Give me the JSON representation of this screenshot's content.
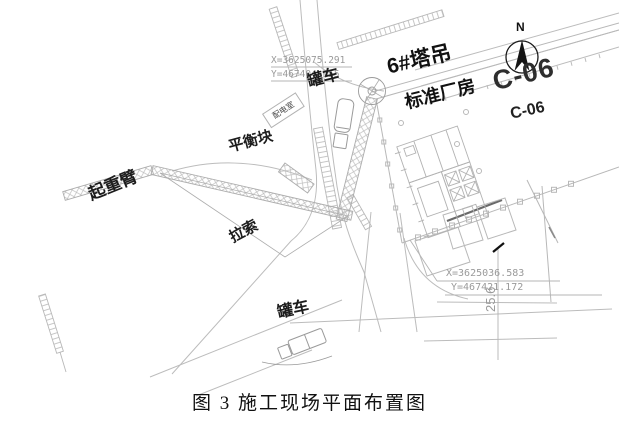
{
  "caption": "图 3 施工现场平面布置图",
  "north_label": "N",
  "labels": {
    "tank_truck_top": "罐车",
    "tank_truck_bottom": "罐车",
    "tower_crane": "6#塔吊",
    "factory_building": "标准厂房",
    "block_code_large": "C-06",
    "block_code_small": "C-06",
    "power_room": "配电室",
    "counterweight": "平衡块",
    "crane_boom": "起重臂",
    "guy_cable": "拉索"
  },
  "coordinates": {
    "north_point": {
      "x": "X=3625075.291",
      "y": "Y=467404.955"
    },
    "south_point": {
      "x": "X=3625036.583",
      "y": "Y=467421.172"
    }
  },
  "dimensions": {
    "road_width": "25.6"
  },
  "colors": {
    "background": "#ffffff",
    "line": "#b8b8b8",
    "line_dark": "#6a6a6a",
    "text_dark": "#1c1c1c",
    "coord_text": "#9a9a9a",
    "north_arrow": "#151515"
  }
}
